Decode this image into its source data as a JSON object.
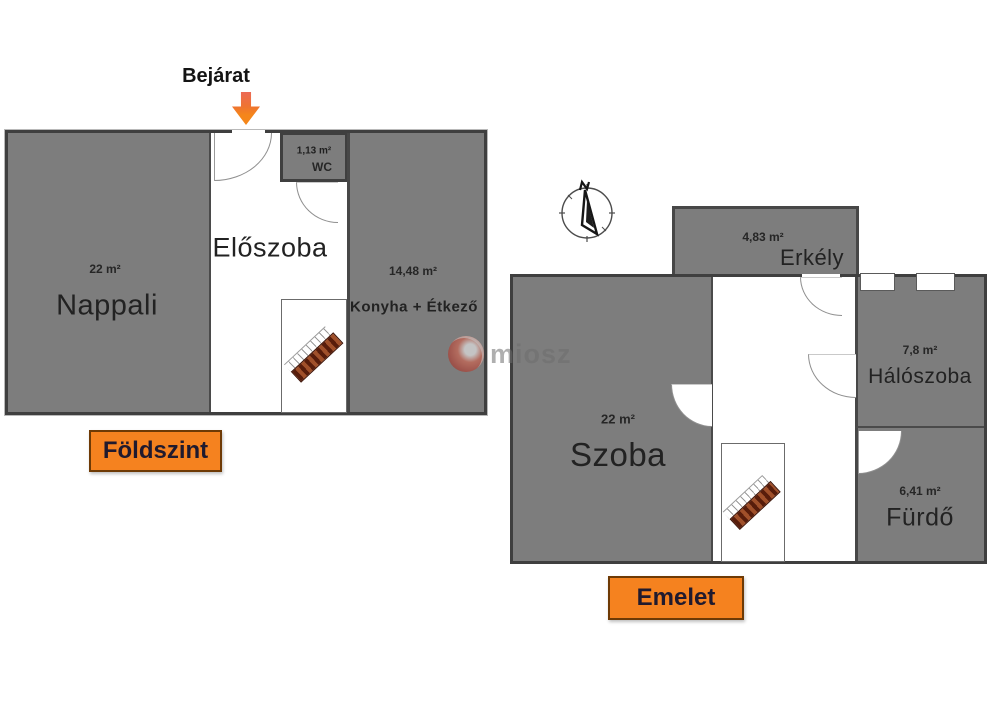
{
  "watermark": {
    "text": "miosz"
  },
  "ground_floor": {
    "entrance_label": "Bejárat",
    "floor_label": "Földszint",
    "rooms": {
      "nappali": {
        "name": "Nappali",
        "area": "22 m²"
      },
      "eloszoba": {
        "name": "Előszoba"
      },
      "wc": {
        "name": "WC",
        "area": "1,13 m²"
      },
      "konyha": {
        "name": "Konyha + Étkező",
        "area": "14,48 m²"
      }
    }
  },
  "upper_floor": {
    "floor_label": "Emelet",
    "compass_letter": "N",
    "rooms": {
      "erkely": {
        "name": "Erkély",
        "area": "4,83 m²"
      },
      "szoba": {
        "name": "Szoba",
        "area": "22 m²"
      },
      "haloszoba": {
        "name": "Hálószoba",
        "area": "7,8 m²"
      },
      "furdo": {
        "name": "Fürdő",
        "area": "6,41 m²"
      }
    }
  },
  "colors": {
    "room_fill": "#7d7d7d",
    "wall": "#3f3f3f",
    "floor_tag_bg": "#f5821f",
    "arrow_orange": "#f5861a",
    "stairs_brown": "#a0502a"
  }
}
